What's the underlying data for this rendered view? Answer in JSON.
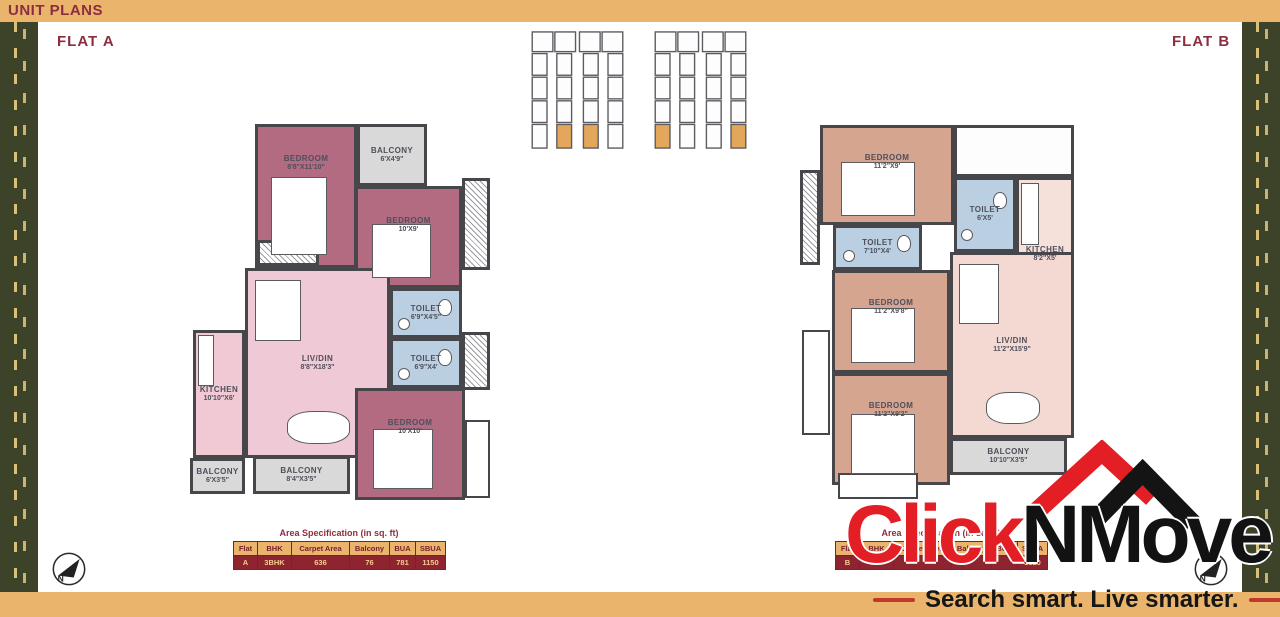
{
  "header": {
    "title": "UNIT PLANS"
  },
  "colors": {
    "bar": "#EAB46C",
    "accent_red": "#8B2E3F",
    "wall": "#47474B",
    "flat_a_bedroom": "#B26B80",
    "flat_a_living": "#EFC9D5",
    "flat_b_bedroom": "#D6A590",
    "flat_b_living": "#F4D9D2",
    "toilet_blue": "#BAD0E2",
    "balcony_gray": "#D9D9D9",
    "keyplan_highlight": "#E3A75C",
    "logo_red": "#E31E24",
    "logo_black": "#141414"
  },
  "flat_a": {
    "label": "FLAT A",
    "rooms": [
      {
        "name": "BEDROOM",
        "dims": "8'8\"X11'10\"",
        "type": "bedroom",
        "x": 70,
        "y": 6,
        "w": 102,
        "h": 144
      },
      {
        "name": "BALCONY",
        "dims": "6'X4'9\"",
        "type": "balcony",
        "x": 172,
        "y": 6,
        "w": 70,
        "h": 62
      },
      {
        "name": "BEDROOM",
        "dims": "10'X9'",
        "type": "bedroom",
        "x": 170,
        "y": 68,
        "w": 107,
        "h": 102
      },
      {
        "name": "LIV/DIN",
        "dims": "8'8\"X18'3\"",
        "type": "livdin",
        "x": 60,
        "y": 150,
        "w": 145,
        "h": 190
      },
      {
        "name": "TOILET",
        "dims": "6'9\"X4'5\"",
        "type": "toilet",
        "x": 205,
        "y": 170,
        "w": 72,
        "h": 50
      },
      {
        "name": "TOILET",
        "dims": "6'9\"X4'",
        "type": "toilet",
        "x": 205,
        "y": 220,
        "w": 72,
        "h": 50
      },
      {
        "name": "KITCHEN",
        "dims": "10'10\"X6'",
        "type": "kitchen",
        "x": 8,
        "y": 212,
        "w": 52,
        "h": 128
      },
      {
        "name": "BEDROOM",
        "dims": "10'X10'",
        "type": "bedroom",
        "x": 170,
        "y": 270,
        "w": 110,
        "h": 112
      },
      {
        "name": "BALCONY",
        "dims": "6'X3'5\"",
        "type": "balcony",
        "x": 5,
        "y": 340,
        "w": 55,
        "h": 36
      },
      {
        "name": "BALCONY",
        "dims": "8'4\"X3'5\"",
        "type": "balcony",
        "x": 68,
        "y": 338,
        "w": 97,
        "h": 38
      },
      {
        "name": "",
        "dims": "",
        "type": "duct",
        "x": 277,
        "y": 60,
        "w": 28,
        "h": 92
      },
      {
        "name": "",
        "dims": "",
        "type": "duct",
        "x": 277,
        "y": 214,
        "w": 28,
        "h": 58
      },
      {
        "name": "",
        "dims": "",
        "type": "ledge",
        "x": 280,
        "y": 302,
        "w": 25,
        "h": 78
      },
      {
        "name": "",
        "dims": "",
        "type": "duct",
        "x": 72,
        "y": 122,
        "w": 62,
        "h": 26
      }
    ],
    "spec": {
      "title": "Area Specification (in sq. ft)",
      "headers": [
        "Flat",
        "BHK",
        "Carpet Area",
        "Balcony",
        "BUA",
        "SBUA"
      ],
      "row": [
        "A",
        "3BHK",
        "636",
        "76",
        "781",
        "1150"
      ]
    }
  },
  "flat_b": {
    "label": "FLAT B",
    "rooms": [
      {
        "name": "BEDROOM",
        "dims": "11'2\"X9'",
        "type": "bedroom",
        "x": 20,
        "y": 10,
        "w": 134,
        "h": 100
      },
      {
        "name": "",
        "dims": "",
        "type": "foyer",
        "x": 154,
        "y": 10,
        "w": 120,
        "h": 52
      },
      {
        "name": "TOILET",
        "dims": "6'X5'",
        "type": "toilet",
        "x": 154,
        "y": 62,
        "w": 62,
        "h": 75
      },
      {
        "name": "KITCHEN",
        "dims": "8'2\"X5'",
        "type": "kitchen",
        "x": 216,
        "y": 62,
        "w": 58,
        "h": 155
      },
      {
        "name": "TOILET",
        "dims": "7'10\"X4'",
        "type": "toilet",
        "x": 33,
        "y": 110,
        "w": 89,
        "h": 45
      },
      {
        "name": "BEDROOM",
        "dims": "11'2\"X9'8\"",
        "type": "bedroom",
        "x": 32,
        "y": 155,
        "w": 118,
        "h": 103
      },
      {
        "name": "LIV/DIN",
        "dims": "11'2\"X15'9\"",
        "type": "livdin",
        "x": 150,
        "y": 137,
        "w": 124,
        "h": 186
      },
      {
        "name": "BEDROOM",
        "dims": "11'2\"X9'2\"",
        "type": "bedroom",
        "x": 32,
        "y": 258,
        "w": 118,
        "h": 112
      },
      {
        "name": "BALCONY",
        "dims": "10'10\"X3'5\"",
        "type": "balcony",
        "x": 150,
        "y": 323,
        "w": 117,
        "h": 37
      },
      {
        "name": "",
        "dims": "",
        "type": "duct",
        "x": 0,
        "y": 55,
        "w": 20,
        "h": 95
      },
      {
        "name": "",
        "dims": "",
        "type": "ledge",
        "x": 2,
        "y": 215,
        "w": 28,
        "h": 105
      },
      {
        "name": "",
        "dims": "",
        "type": "ledge",
        "x": 38,
        "y": 358,
        "w": 80,
        "h": 26
      }
    ],
    "spec": {
      "title": "Area Specification (in sq. ft)",
      "headers": [
        "Flat",
        "BHK",
        "Carpet Area",
        "Balcony",
        "BUA",
        "SBUA"
      ],
      "row": [
        "B",
        "",
        "",
        "",
        "",
        "1320"
      ]
    }
  },
  "logo": {
    "brand_red": "Click",
    "brand_black": "NMove",
    "tagline": "Search smart. Live smarter."
  },
  "compass_label": "N"
}
